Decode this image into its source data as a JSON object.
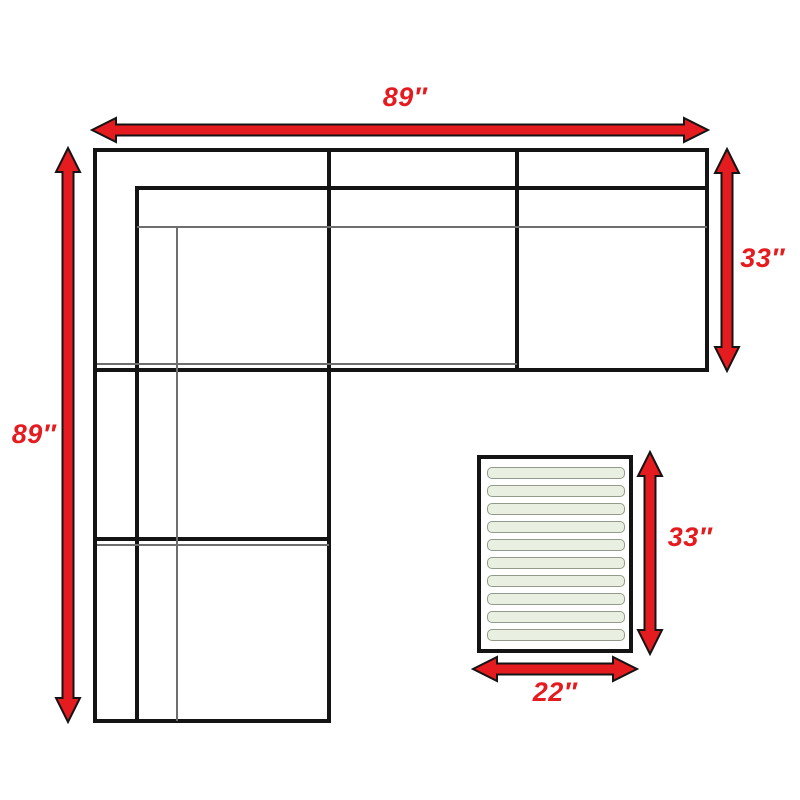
{
  "colors": {
    "background": "#ffffff",
    "arrow_red": "#e41b1f",
    "label_red": "#e41b1f",
    "line_black": "#141414",
    "thin_line": "#6e6e6e",
    "slat_fill": "#eaf0e1",
    "slat_border": "#929a8c"
  },
  "dimensions": {
    "sofa_width": "89″",
    "sofa_length": "89″",
    "sofa_depth": "33″",
    "table_length": "33″",
    "table_width": "22″"
  },
  "table": {
    "slat_count": 10
  }
}
